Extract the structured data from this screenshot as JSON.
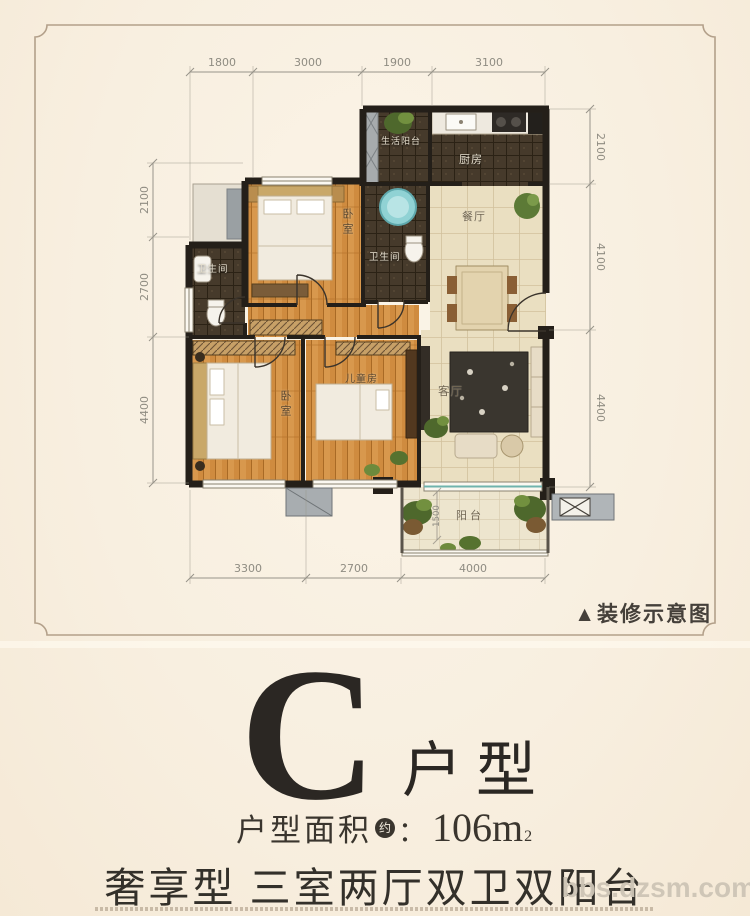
{
  "floor_plan": {
    "caption": "▲装修示意图",
    "rooms": {
      "service_balcony": "生活阳台",
      "kitchen": "厨房",
      "dining": "餐厅",
      "bath_main": "卫生间",
      "bath_second": "卫生间",
      "bedroom_master": "卧室",
      "bedroom_second": "卧室",
      "kids_room": "儿童房",
      "living": "客厅",
      "balcony": "阳台"
    },
    "dims": {
      "top": [
        "1800",
        "3000",
        "1900",
        "3100"
      ],
      "left": [
        "2100",
        "2700",
        "4400"
      ],
      "right": [
        "2100",
        "4100",
        "4400"
      ],
      "bottom": [
        "3300",
        "2700",
        "4000"
      ],
      "balcony_depth": "1500"
    }
  },
  "unit": {
    "letter": "C",
    "suffix": "户型",
    "area_label": "户型面积",
    "area_badge": "约",
    "colon": "：",
    "area_value": "106m",
    "area_exponent": "2",
    "slogan": "奢享型 三室两厅双卫双阳台"
  },
  "watermark": "bbs.dzsm.com",
  "colors": {
    "background": "#f8efe1",
    "frame_line": "#b3a08a",
    "wall": "#241f19",
    "wood_floor": "#cf8b3f",
    "dark_tile": "#463a2b",
    "light_tile": "#eadfc1",
    "accent_teal": "#8fd2d6",
    "plant_green": "#4e682c",
    "dim_text": "#8f8c82",
    "headline_text": "#2b2723",
    "watermark_gray": "#cdc5b6"
  }
}
